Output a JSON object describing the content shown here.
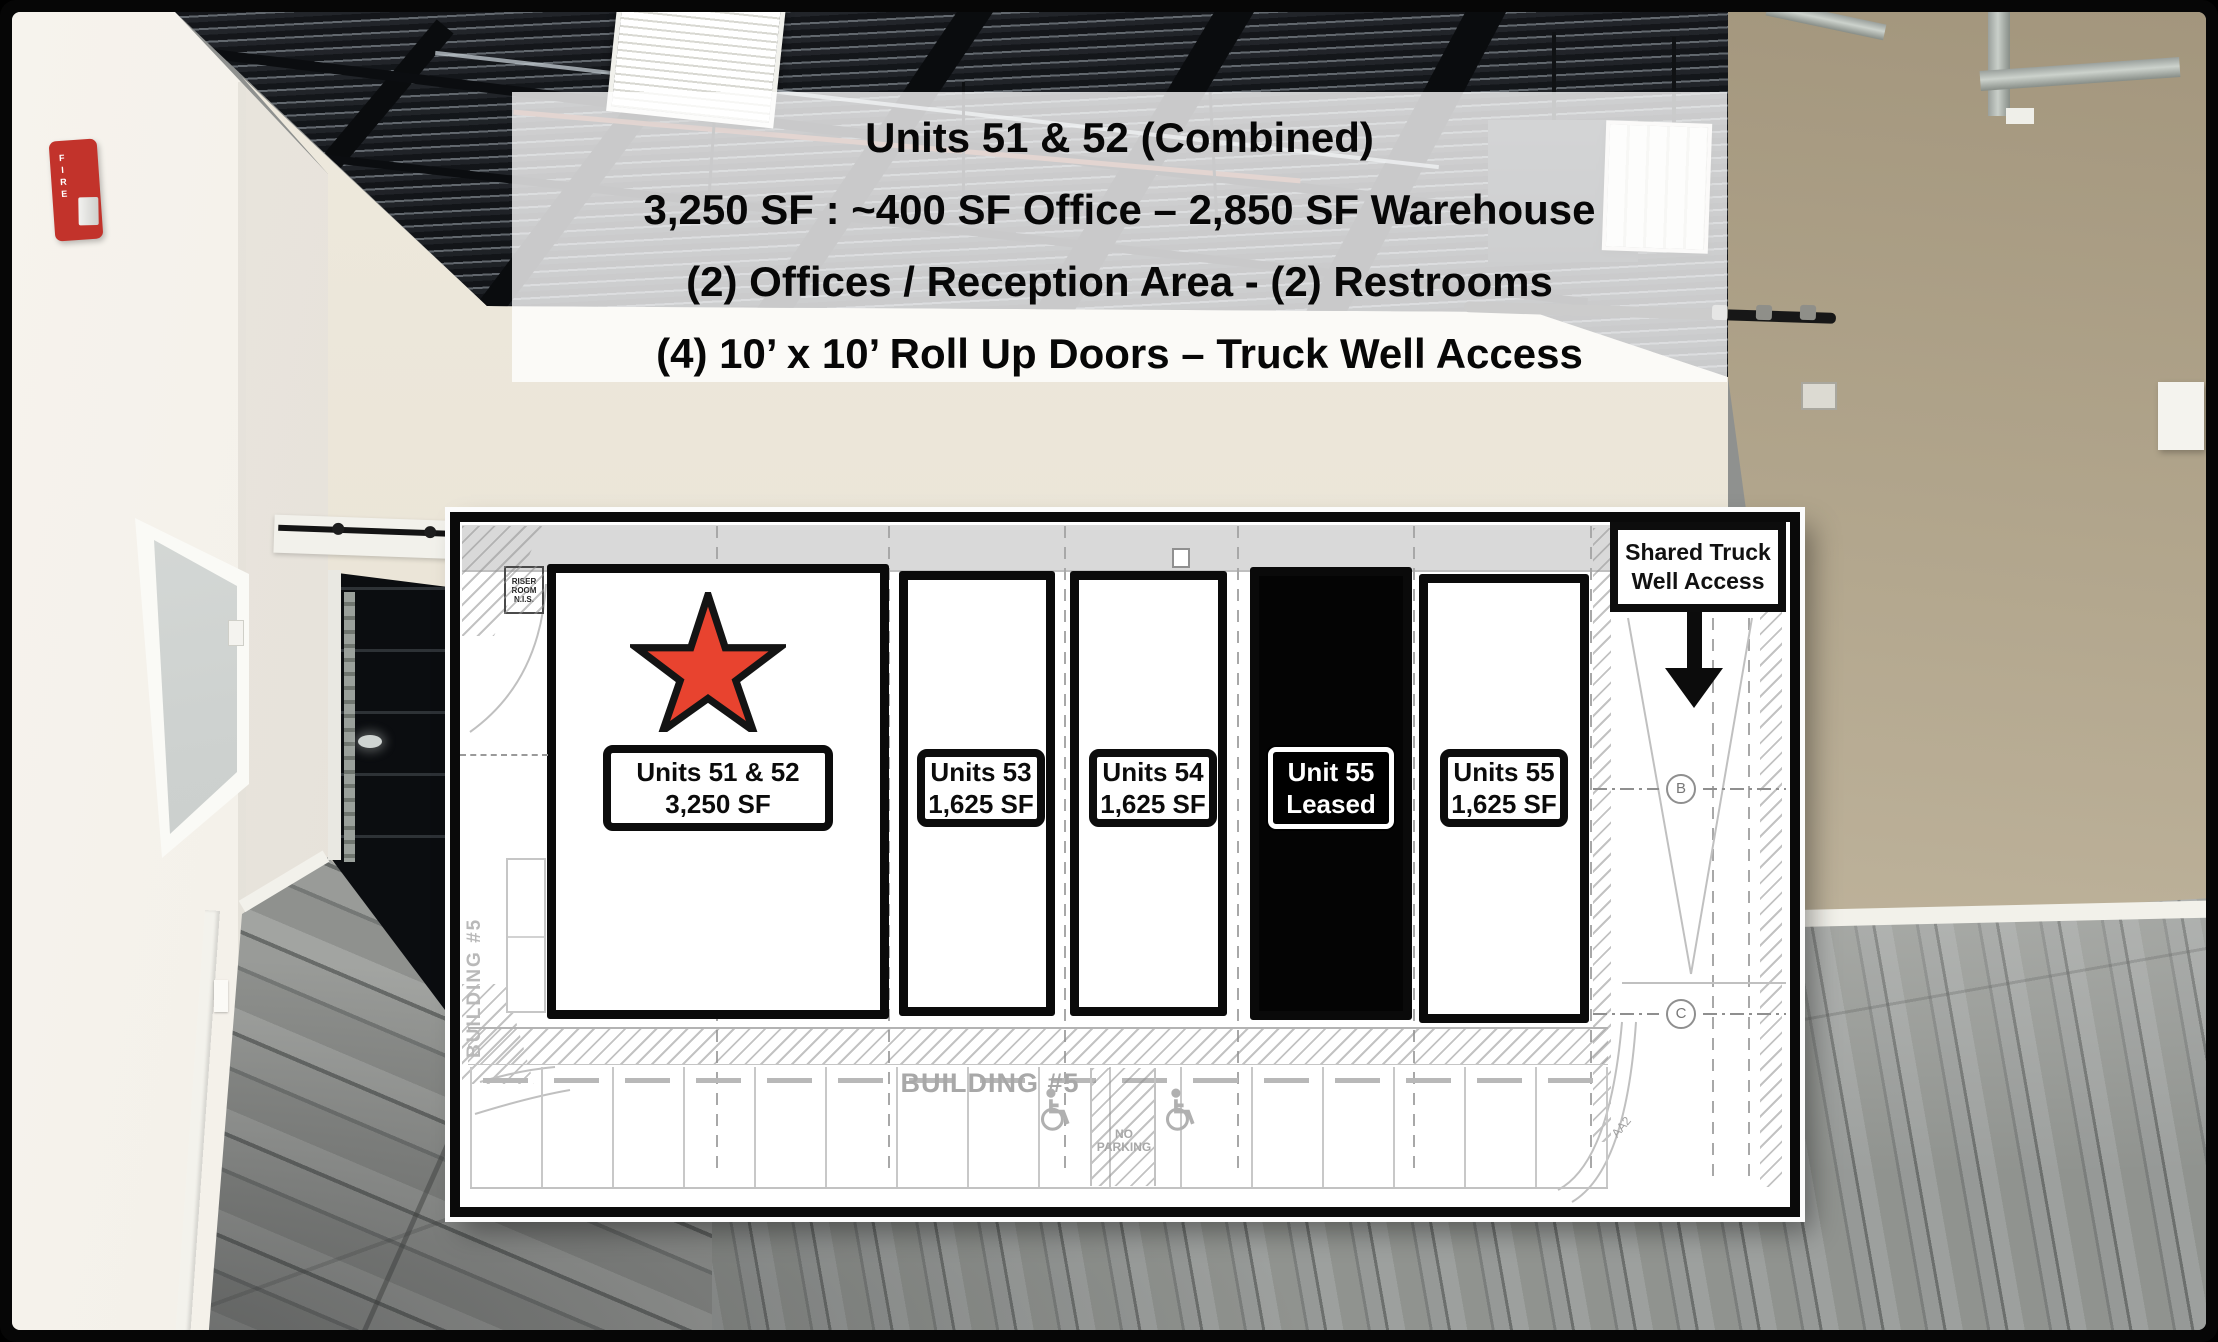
{
  "flyer": {
    "headline_lines": [
      "Units 51 & 52 (Combined)",
      "3,250 SF : ~400 SF Office – 2,850 SF Warehouse",
      "(2) Offices / Reception Area - (2) Restrooms",
      "(4) 10’ x 10’ Roll Up Doors – Truck Well Access"
    ]
  },
  "floor_plan": {
    "units": [
      {
        "name": "Units 51 & 52",
        "size": "3,250 SF",
        "status": "available",
        "starred": true
      },
      {
        "name": "Units 53",
        "size": "1,625 SF",
        "status": "available",
        "starred": false
      },
      {
        "name": "Units 54",
        "size": "1,625 SF",
        "status": "available",
        "starred": false
      },
      {
        "name": "Unit 55",
        "size": "Leased",
        "status": "leased",
        "starred": false
      },
      {
        "name": "Units 55",
        "size": "1,625 SF",
        "status": "available",
        "starred": false
      }
    ],
    "truck_well_note_line1": "Shared Truck",
    "truck_well_note_line2": "Well Access",
    "building_label": "BUILDING #5",
    "building_label_side": "BUILDING #5",
    "riser_room_note": "RISER ROOM N.I.S.",
    "no_parking_note": "NO PARKING",
    "grid_bubble_b": "B",
    "grid_bubble_c": "C",
    "detail_tag": "AA2",
    "colors": {
      "highlight_star": "#e8432f",
      "leased_fill": "#000000",
      "dock_band": "#d9d9d9",
      "line_gray": "#c0c0c0"
    }
  },
  "scene": {
    "fire_alarm_label": "FIRE"
  }
}
